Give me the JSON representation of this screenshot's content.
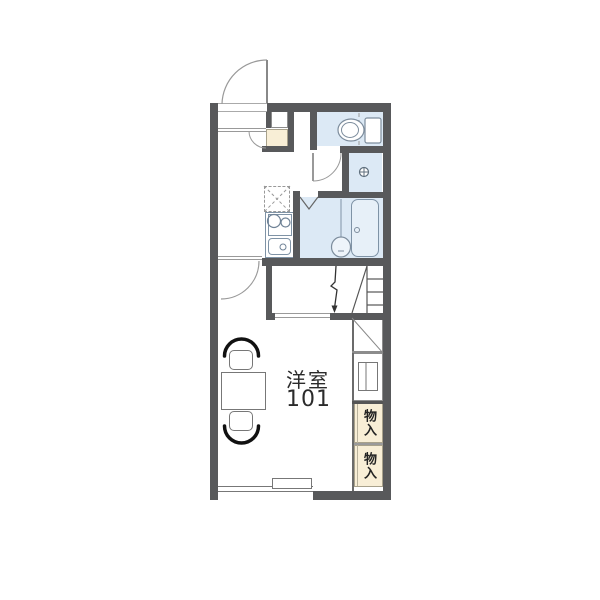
{
  "floorplan": {
    "room": {
      "name": "洋室",
      "number": "101"
    },
    "storages": [
      {
        "label": "物入"
      },
      {
        "label": "物入"
      }
    ],
    "colors": {
      "wall": "#58595b",
      "water_fill": "#dce9f5",
      "water_border": "#7f93a6",
      "storage_fill": "#f8eed6",
      "outline": "#8c8c8c",
      "text": "#2b2b2b"
    }
  }
}
